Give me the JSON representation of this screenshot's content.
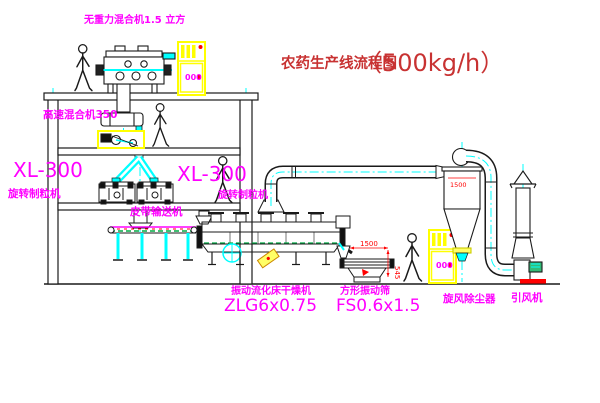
{
  "title": {
    "name": "农药生产线流程图",
    "capacity": "（500kg/h）"
  },
  "labels": {
    "gravity_free_mixer": "无重力混合机1.5 立方",
    "high_speed_mixer": "高速混合机350",
    "granulator_left_model": "XL-300",
    "granulator_left_name": "旋转制粒机",
    "granulator_mid_model": "XL-300",
    "granulator_mid_name": "旋转制粒机",
    "belt_conveyor": "皮带输送机",
    "dryer_name": "振动流化床干燥机",
    "dryer_model": "ZLG6x0.75",
    "sieve_name": "方形振动筛",
    "sieve_model": "FS0.6x1.5",
    "cyclone": "旋风除尘器",
    "induced_draft_fan": "引风机"
  },
  "dimensions": {
    "sieve_length": "1500",
    "sieve_height": "545",
    "cyclone_height": "1500"
  },
  "cabinets": {
    "display": "000"
  },
  "colors": {
    "label_magenta": "#ff00ff",
    "title_red": "#c83232",
    "dimension_red": "#ff0000",
    "line_black": "#1a1a1a",
    "accent_yellow": "#ffff00",
    "accent_cyan": "#00ffff",
    "accent_green": "#00aa44"
  }
}
